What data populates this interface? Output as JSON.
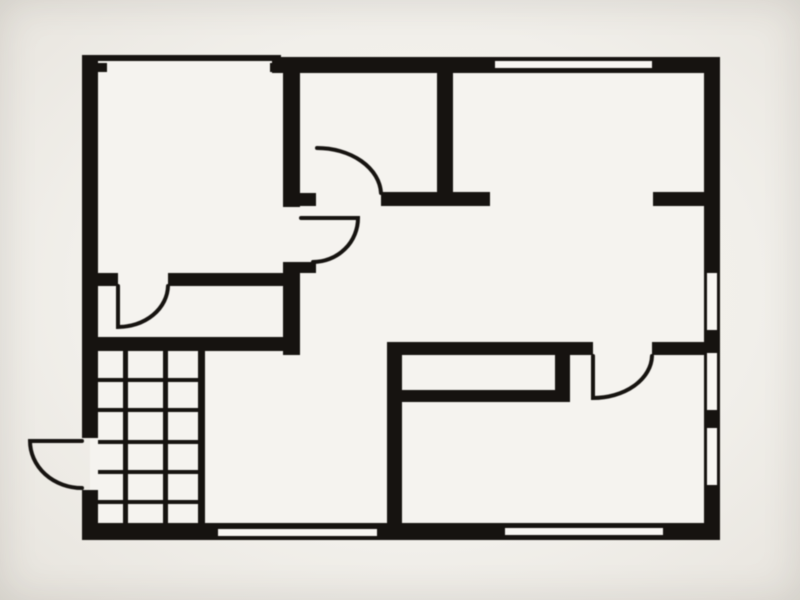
{
  "canvas": {
    "width": 800,
    "height": 600
  },
  "colors": {
    "wall": "#161310",
    "floor": "#f5f3ef",
    "window_fill": "#f8f6f2",
    "paper_center": "#f6f4f0",
    "paper_edge": "#e5e2db"
  },
  "plan_interior": {
    "x": 90,
    "y": 60,
    "w": 622,
    "h": 472
  },
  "walls": [
    {
      "name": "closet-top-thin-wall",
      "x": 93,
      "y": 55,
      "w": 188,
      "h": 6
    },
    {
      "name": "closet-top-left-jamb",
      "x": 95,
      "y": 63,
      "w": 12,
      "h": 9
    },
    {
      "name": "closet-top-right-jamb",
      "x": 270,
      "y": 63,
      "w": 13,
      "h": 9
    },
    {
      "name": "top-exterior-wall",
      "x": 272,
      "y": 57,
      "w": 448,
      "h": 16
    },
    {
      "name": "left-exterior-wall-upper",
      "x": 82,
      "y": 55,
      "w": 16,
      "h": 383
    },
    {
      "name": "left-exterior-wall-lower",
      "x": 82,
      "y": 490,
      "w": 16,
      "h": 50
    },
    {
      "name": "bottom-exterior-wall",
      "x": 82,
      "y": 523,
      "w": 638,
      "h": 17
    },
    {
      "name": "right-exterior-wall",
      "x": 704,
      "y": 57,
      "w": 16,
      "h": 483
    },
    {
      "name": "closet-right-wall-upper",
      "x": 283,
      "y": 61,
      "w": 17,
      "h": 146
    },
    {
      "name": "closet-right-wall-lower",
      "x": 283,
      "y": 262,
      "w": 17,
      "h": 93
    },
    {
      "name": "closet-door-bottom-jamb",
      "x": 300,
      "y": 262,
      "w": 16,
      "h": 11
    },
    {
      "name": "hall-top-wall-left",
      "x": 283,
      "y": 193,
      "w": 33,
      "h": 13
    },
    {
      "name": "hall-top-wall-right",
      "x": 381,
      "y": 192,
      "w": 109,
      "h": 14
    },
    {
      "name": "center-divider-wall",
      "x": 437,
      "y": 59,
      "w": 16,
      "h": 134
    },
    {
      "name": "topright-room-stub-wall",
      "x": 653,
      "y": 192,
      "w": 55,
      "h": 14
    },
    {
      "name": "closet-bottom-wall-left",
      "x": 98,
      "y": 273,
      "w": 20,
      "h": 13
    },
    {
      "name": "closet-bottom-wall-right",
      "x": 168,
      "y": 273,
      "w": 115,
      "h": 13
    },
    {
      "name": "landing-wall",
      "x": 98,
      "y": 337,
      "w": 202,
      "h": 14
    },
    {
      "name": "bottomright-room-left-wall",
      "x": 387,
      "y": 343,
      "w": 15,
      "h": 185
    },
    {
      "name": "bottomright-room-top-wall-left",
      "x": 387,
      "y": 342,
      "w": 206,
      "h": 13
    },
    {
      "name": "bottomright-room-top-wall-right",
      "x": 652,
      "y": 342,
      "w": 56,
      "h": 13
    },
    {
      "name": "counter-bottom-edge",
      "x": 398,
      "y": 390,
      "w": 157,
      "h": 12
    },
    {
      "name": "counter-right-edge",
      "x": 555,
      "y": 355,
      "w": 15,
      "h": 47
    }
  ],
  "windows": [
    {
      "name": "window-top-wall",
      "x": 495,
      "y": 61,
      "w": 157,
      "h": 7
    },
    {
      "name": "window-bottom-left",
      "x": 218,
      "y": 529,
      "w": 159,
      "h": 7
    },
    {
      "name": "window-bottom-right",
      "x": 505,
      "y": 528,
      "w": 158,
      "h": 7
    },
    {
      "name": "window-right-upper",
      "x": 707,
      "y": 273,
      "w": 10,
      "h": 57
    },
    {
      "name": "window-right-middle",
      "x": 707,
      "y": 353,
      "w": 10,
      "h": 57
    },
    {
      "name": "window-right-lower",
      "x": 707,
      "y": 428,
      "w": 10,
      "h": 57
    }
  ],
  "doors": [
    {
      "name": "door-bathroom",
      "path": "M317,148 A64,47 0 0 1 381,193"
    },
    {
      "name": "door-closet-to-hall",
      "path": "M301,218 L358,218 A45,44 0 0 1 313,262"
    },
    {
      "name": "door-entry-exterior",
      "path": "M82,441 L30,441 A52,47 0 0 0 82,488"
    },
    {
      "name": "door-bottomright-room",
      "path": "M593,356 L593,398 A59,43 0 0 0 652,356"
    },
    {
      "name": "door-closet-to-landing",
      "path": "M118,286 L118,327 A50,42 0 0 0 168,286"
    }
  ],
  "stairs": {
    "name": "staircase",
    "area": {
      "x": 98,
      "y": 351,
      "w": 107,
      "h": 172
    },
    "right_edge": {
      "x": 198,
      "y": 351,
      "w": 7,
      "h": 172
    },
    "dividers": [
      {
        "x": 123,
        "y": 351,
        "w": 5,
        "h": 172
      },
      {
        "x": 163,
        "y": 351,
        "w": 5,
        "h": 172
      }
    ],
    "tread_ys": [
      378,
      408,
      440,
      470,
      500
    ],
    "tread": {
      "x": 98,
      "w": 102,
      "h": 4
    }
  }
}
